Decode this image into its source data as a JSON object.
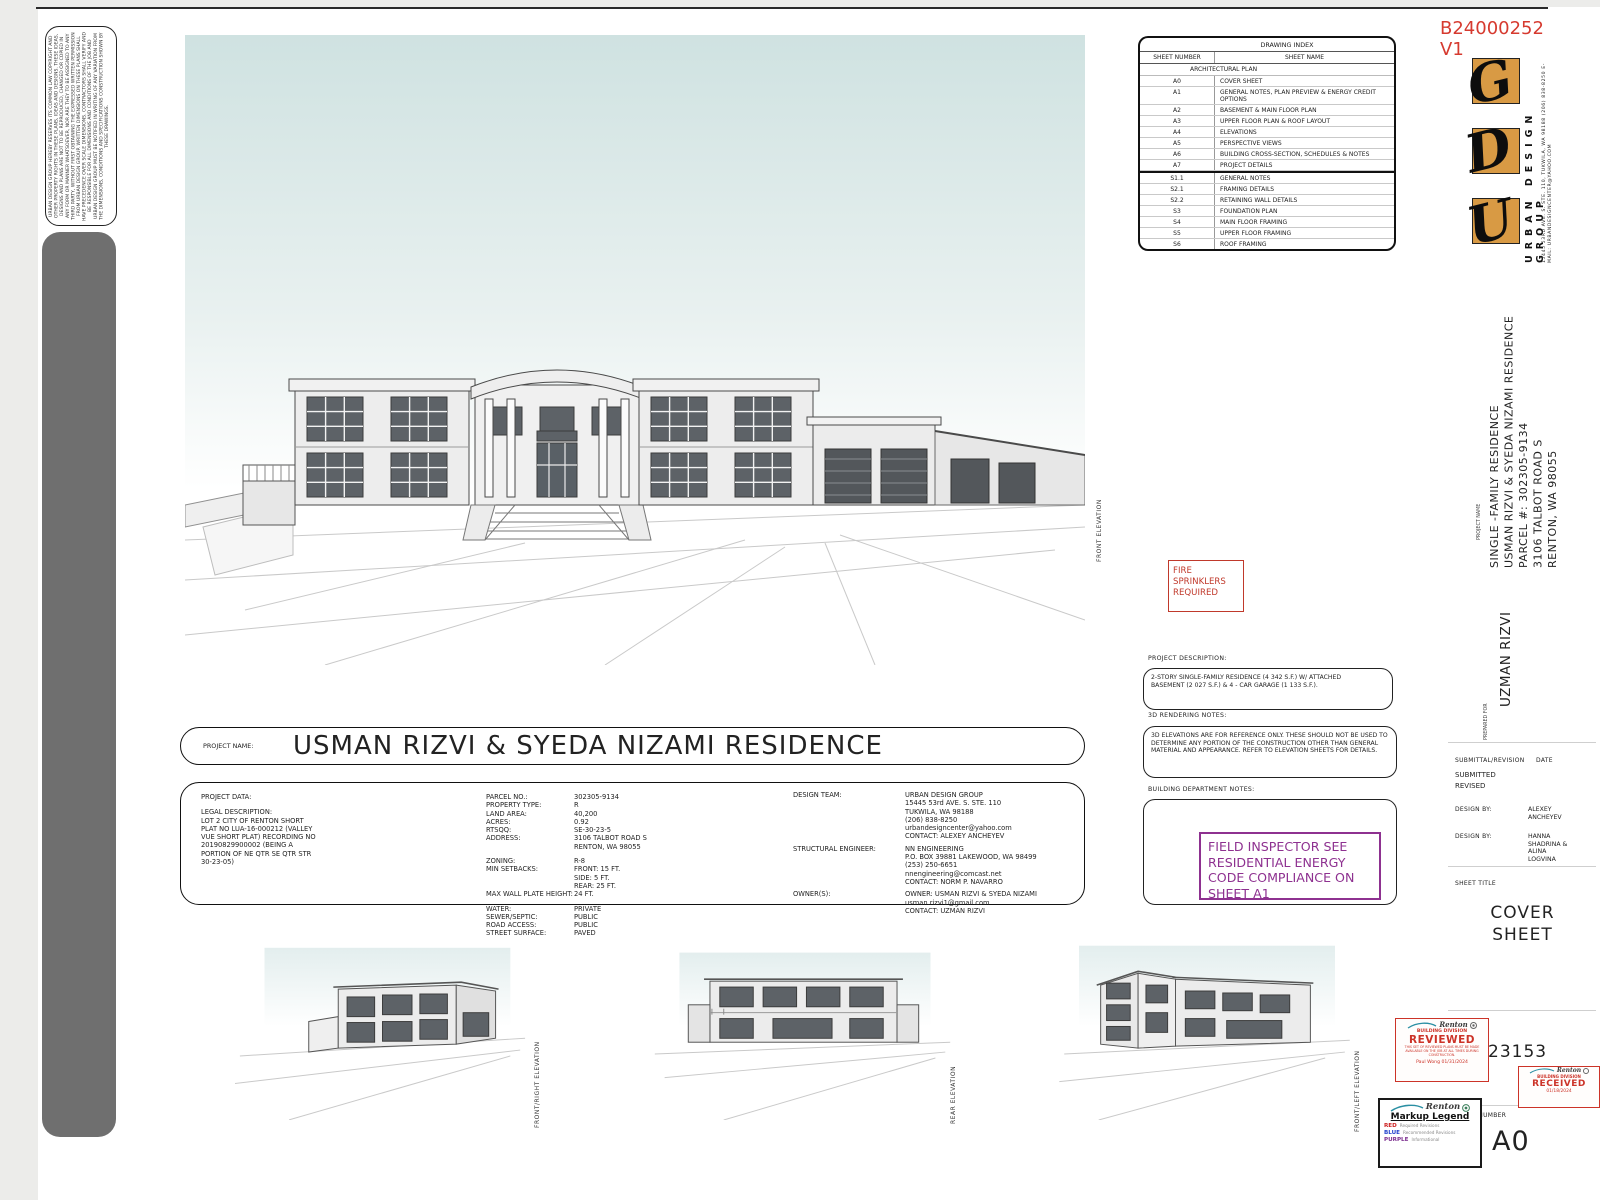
{
  "permit": {
    "number": "B24000252",
    "version": "V1",
    "color": "#d63a2f"
  },
  "firm": {
    "name": "URBAN DESIGN GROUP",
    "address": "15445 53RD AVE. S. STE. 110, TUKWILA, WA 98188",
    "phone_email": "(206) 838-8250 E-MAIL: URBANDESIGNCENTER@YAHOO.COM",
    "logo_letters": [
      "U",
      "D",
      "G"
    ],
    "logo_color": "#d89a44"
  },
  "copyright_text": "URBAN DESIGN GROUP HEREBY RESERVES ITS COMMON LAW COPYRIGHT AND OTHER PROPERTY RIGHTS IN THESE PLANS, IDEAS AND DESIGNS. THESE IDEAS, DESIGNS AND PLANS ARE NOT TO BE REPRODUCED, CHANGED OR COPIED IN ANY FORM OR MANNER WHATSOEVER, NOR ARE THEY TO BE ASSIGNED TO ANY THIRD PARTY, WITHOUT FIRST OBTAINING THE EXPRESSED WRITTEN PERMISSION FROM URBAN DESIGN GROUP. WRITTEN DIMENSIONS ON THESE PLANS SHALL HAVE PRECEDENCE OVER SCALE DIMENSIONS. CONTRACTORS SHALL VERIFY AND BE RESPONSIBLE FOR ALL DIMENSIONS AND CONDITIONS OF THE JOB AND URBAN DESIGN GROUP MUST BE NOTIFIED IN WRITING OF ANY VARIATION FROM THE DIMENSIONS, CONDITIONS AND SPECIFICATIONS CONSTRUCTION SHOWN BY THESE DRAWINGS.",
  "drawing_index": {
    "title": "DRAWING INDEX",
    "headers": [
      "SHEET NUMBER",
      "SHEET NAME"
    ],
    "section_label": "ARCHITECTURAL PLAN",
    "rows": [
      {
        "n": "A0",
        "s": "COVER SHEET"
      },
      {
        "n": "A1",
        "s": "GENERAL NOTES, PLAN PREVIEW & ENERGY CREDIT OPTIONS"
      },
      {
        "n": "A2",
        "s": "BASEMENT & MAIN FLOOR PLAN"
      },
      {
        "n": "A3",
        "s": "UPPER FLOOR PLAN & ROOF LAYOUT"
      },
      {
        "n": "A4",
        "s": "ELEVATIONS"
      },
      {
        "n": "A5",
        "s": "PERSPECTIVE VIEWS"
      },
      {
        "n": "A6",
        "s": "BUILDING CROSS-SECTION, SCHEDULES & NOTES"
      },
      {
        "n": "A7",
        "s": "PROJECT DETAILS"
      },
      {
        "n": "S1.1",
        "s": "GENERAL NOTES"
      },
      {
        "n": "S2.1",
        "s": "FRAMING DETAILS"
      },
      {
        "n": "S2.2",
        "s": "RETAINING WALL DETAILS"
      },
      {
        "n": "S3",
        "s": "FOUNDATION PLAN"
      },
      {
        "n": "S4",
        "s": "MAIN FLOOR FRAMING"
      },
      {
        "n": "S5",
        "s": "UPPER FLOOR FRAMING"
      },
      {
        "n": "S6",
        "s": "ROOF FRAMING"
      }
    ]
  },
  "main_view_label": "FRONT ELEVATION",
  "fire_note": "FIRE\nSPRINKLERS\nREQUIRED",
  "sections": {
    "project_description": {
      "label": "PROJECT DESCRIPTION:",
      "text": "2-STORY SINGLE-FAMILY RESIDENCE (4 342 S.F.) W/ ATTACHED\nBASEMENT (2 027 S.F.) & 4 - CAR GARAGE (1 133 S.F.)."
    },
    "rendering_notes": {
      "label": "3D RENDERING NOTES:",
      "text": "3D ELEVATIONS ARE FOR REFERENCE ONLY. THESE SHOULD NOT BE USED TO\nDETERMINE ANY PORTION OF THE CONSTRUCTION OTHER THAN GENERAL\nMATERIAL AND APPEARANCE. REFER TO ELEVATION SHEETS FOR DETAILS."
    },
    "building_dept": {
      "label": "BUILDING DEPARTMENT NOTES:",
      "stamp": "FIELD INSPECTOR SEE RESIDENTIAL ENERGY CODE COMPLIANCE ON SHEET A1",
      "stamp_color": "#8e3190"
    }
  },
  "project_name_bar": {
    "label": "PROJECT NAME:",
    "value": "USMAN RIZVI & SYEDA NIZAMI  RESIDENCE"
  },
  "project_data": {
    "title": "PROJECT DATA:",
    "legal_label": "LEGAL DESCRIPTION:",
    "legal_text": "LOT 2 CITY OF RENTON SHORT\nPLAT NO LUA-16-000212 (VALLEY\nVUE SHORT PLAT) RECORDING NO\n20190829900002 (BEING A\nPORTION OF NE QTR SE QTR STR\n30-23-05)",
    "site_fields": [
      {
        "label": "PARCEL NO.:",
        "value": "302305-9134"
      },
      {
        "label": "PROPERTY TYPE:",
        "value": "R"
      },
      {
        "label": "LAND AREA:",
        "value": "40,200"
      },
      {
        "label": "ACRES:",
        "value": "0.92"
      },
      {
        "label": "RTSQQ:",
        "value": "SE-30-23-5"
      },
      {
        "label": "ADDRESS:",
        "value": "3106 TALBOT ROAD S\nRENTON, WA 98055"
      },
      {
        "label": "ZONING:",
        "value": "R-8"
      },
      {
        "label": "MIN SETBACKS:",
        "value": "FRONT:   15 FT.\nSIDE:       5 FT.\nREAR:      25 FT."
      },
      {
        "label": "MAX WALL PLATE HEIGHT:",
        "value": "24 FT."
      },
      {
        "label": "WATER:",
        "value": "PRIVATE"
      },
      {
        "label": "SEWER/SEPTIC:",
        "value": "PUBLIC"
      },
      {
        "label": "ROAD ACCESS:",
        "value": "PUBLIC"
      },
      {
        "label": "STREET SURFACE:",
        "value": "PAVED"
      }
    ],
    "team_fields": [
      {
        "label": "DESIGN TEAM:",
        "value": "URBAN DESIGN GROUP\n15445 53rd AVE. S. STE. 110\nTUKWILA, WA 98188\n(206) 838-8250\nurbandesigncenter@yahoo.com\nCONTACT: ALEXEY ANCHEYEV"
      },
      {
        "label": "STRUCTURAL ENGINEER:",
        "value": "NN ENGINEERING\nP.O. BOX 39881 LAKEWOOD, WA 98499\n(253) 250-6651\nnnengineering@comcast.net\nCONTACT: NORM P. NAVARRO"
      },
      {
        "label": "OWNER(S):",
        "value": "OWNER: USMAN RIZVI & SYEDA NIZAMI\nusman.rizvi1@gmail.com\nCONTACT: UZMAN RIZVI"
      }
    ]
  },
  "elevation_labels": [
    "FRONT/RIGHT ELEVATION",
    "REAR ELEVATION",
    "FRONT/LEFT ELEVATION"
  ],
  "titleblock": {
    "project_name_label": "PROJECT NAME",
    "project_name_lines": "SINGLE -FAMILY RESIDENCE\nUSMAN RIZVI & SYEDA NIZAMI RESIDENCE\nPARCEL #: 302305-9134\n3106 TALBOT ROAD S\nRENTON, WA 98055",
    "prepared_for_label": "PREPARED FOR",
    "prepared_for": "UZMAN RIZVI",
    "submittal_label": "SUBMITTAL/REVISION",
    "date_label": "DATE",
    "submitted": "SUBMITTED",
    "revised": "REVISED",
    "design_by_label_1": "DESIGN BY:",
    "designer_1": "ALEXEY\nANCHEYEV",
    "design_by_label_2": "DESIGN BY:",
    "designer_2": "HANNA\nSHADRINA &\nALINA\nLOGVINA",
    "sheet_title_label": "SHEET TITLE",
    "sheet_title": "COVER\nSHEET",
    "project_number_label": "PROJECT\nNUMBER",
    "project_number": "23153",
    "sheet_number_label": "SHEET NUMBER",
    "sheet_number": "A0"
  },
  "stamps": {
    "reviewed": {
      "city": "Renton",
      "division": "BUILDING DIVISION",
      "word": "REVIEWED",
      "note": "THIS SET OF REVIEWED PLANS MUST BE MADE\nAVAILABLE ON THE JOB AT ALL TIMES DURING\nCONSTRUCTION.",
      "signed": "Paul Wong 01/31/2024",
      "color": "#cc3328"
    },
    "received": {
      "city": "Renton",
      "division": "BUILDING DIVISION",
      "word": "RECEIVED",
      "date": "01/18/2024",
      "color": "#cc3328"
    },
    "markup_legend": {
      "city": "Renton",
      "title": "Markup Legend",
      "rows": [
        {
          "name": "RED",
          "desc": "Required Revisions",
          "hex": "#cc1f1f"
        },
        {
          "name": "BLUE",
          "desc": "Recommended Revisions",
          "hex": "#1f3fcc"
        },
        {
          "name": "PURPLE",
          "desc": "Informational",
          "hex": "#7b2d8e"
        }
      ]
    }
  }
}
